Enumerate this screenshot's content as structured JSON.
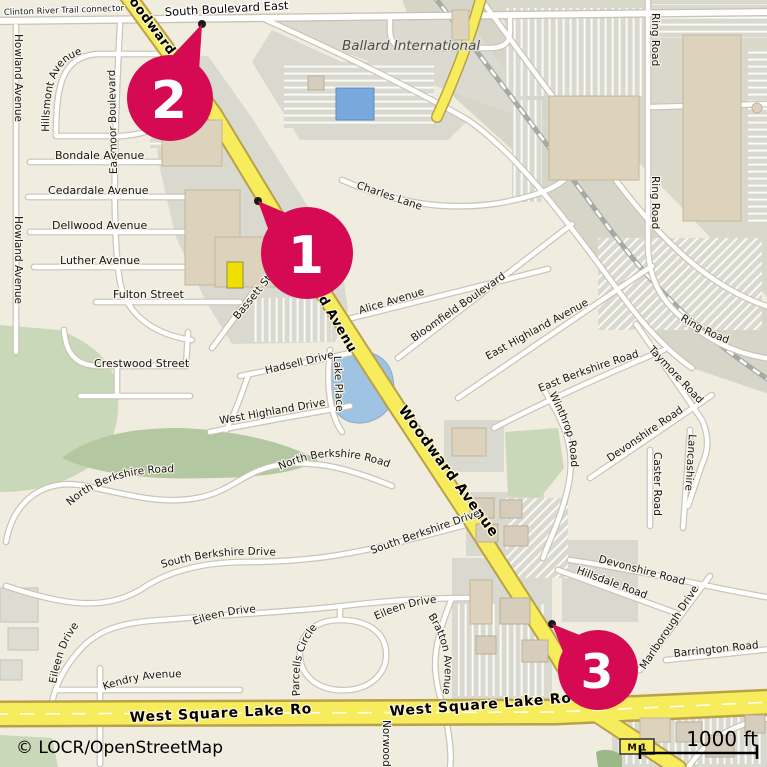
{
  "map": {
    "attribution": "© LOCR/OpenStreetMap",
    "scale_label": "1000 ft",
    "route_shield": "M 1",
    "markers": [
      {
        "label": "1"
      },
      {
        "label": "2"
      },
      {
        "label": "3"
      }
    ],
    "area_labels": {
      "ballard_international": "Ballard International"
    },
    "street_labels": {
      "clinton_trail": "Clinton River Trail connector",
      "south_boulevard_east": "South Boulevard East",
      "woodward": "Woodward Avenue",
      "howland": "Howland Avenue",
      "hillsmont": "Hillsmont Avenue",
      "earlmoor": "Earlmoor Boulevard",
      "bondale": "Bondale Avenue",
      "cedardale": "Cedardale Avenue",
      "dellwood": "Dellwood Avenue",
      "luther": "Luther Avenue",
      "fulton": "Fulton Street",
      "crestwood": "Crestwood Street",
      "bassett": "Bassett Street",
      "charles": "Charles Lane",
      "alice": "Alice Avenue",
      "bloomfield": "Bloomfield Boulevard",
      "east_highland": "East Highland Avenue",
      "east_berkshire": "East Berkshire Road",
      "taymore": "Taymore Road",
      "ring_road": "Ring Road",
      "winthrop": "Winthrop Road",
      "devonshire": "Devonshire Road",
      "caster": "Caster Road",
      "lancashire": "Lancashire",
      "hillsdale": "Hillsdale Road",
      "marlborough": "Marlborough Drive",
      "barrington": "Barrington Road",
      "hadsell": "Hadsell Drive",
      "lake_place": "Lake Place",
      "west_highland": "West Highland Drive",
      "north_berkshire": "North Berkshire Road",
      "south_berkshire": "South Berkshire Drive",
      "eileen": "Eileen Drive",
      "kendry": "Kendry Avenue",
      "bratton": "Bratton Avenue",
      "parcells": "Parcells Circle",
      "norwood": "Norwood",
      "west_square_lake": "West Square Lake Road"
    }
  },
  "colors": {
    "marker": "#d60a52",
    "marker_number": "#ffffff",
    "primary_road": "#f7ec5c",
    "minor_road": "#ffffff",
    "water": "#9fc3e2",
    "water_building": "#7aa7dc",
    "green_area": "#c9d8b9",
    "green_dark": "#b3c7a0",
    "industrial_gray": "#d8d8cb",
    "building": "#ddd2bb",
    "poi_building_yellow": "#f0e000",
    "background": "#f0ecdf"
  }
}
